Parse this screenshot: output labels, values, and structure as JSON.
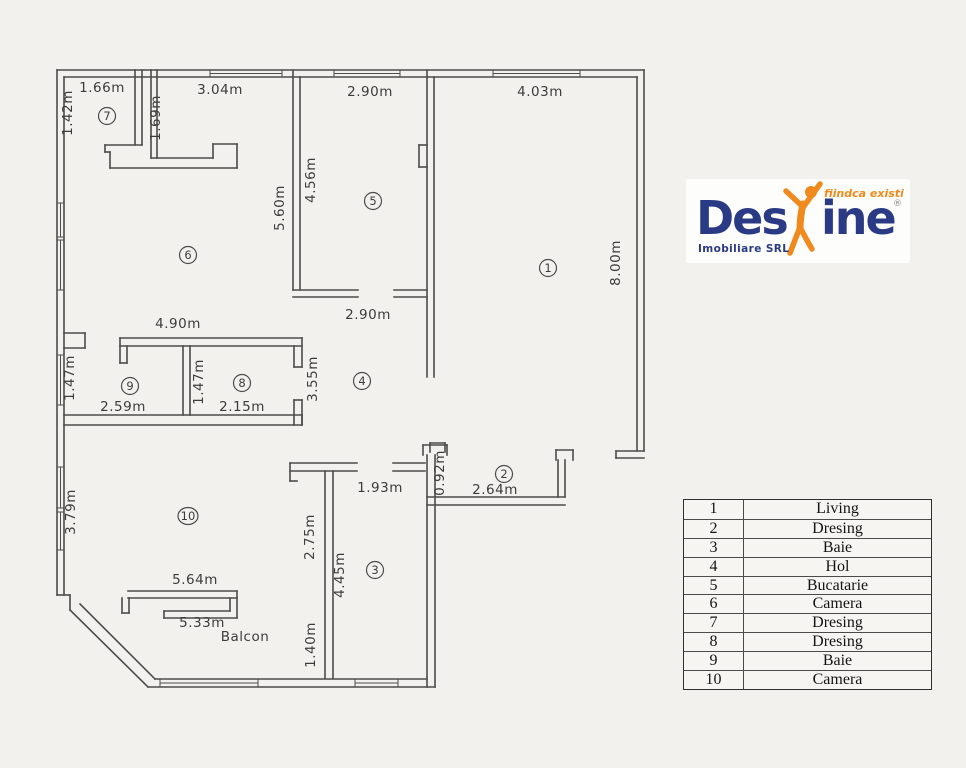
{
  "floorplan": {
    "line_color": "#4c4c4c",
    "text_color": "#3c3c3c",
    "walls": [
      [
        57,
        70,
        644,
        70
      ],
      [
        64,
        77,
        637,
        77
      ],
      [
        644,
        70,
        644,
        451
      ],
      [
        637,
        77,
        637,
        451
      ],
      [
        644,
        451,
        616,
        451
      ],
      [
        616,
        451,
        616,
        458
      ],
      [
        616,
        458,
        644,
        458
      ],
      [
        57,
        70,
        57,
        595
      ],
      [
        64,
        77,
        64,
        595
      ],
      [
        64,
        333,
        85,
        333
      ],
      [
        85,
        333,
        85,
        348
      ],
      [
        64,
        348,
        85,
        348
      ],
      [
        57,
        595,
        70,
        595
      ],
      [
        70,
        595,
        70,
        610
      ],
      [
        70,
        610,
        148,
        687
      ],
      [
        80,
        604,
        155,
        679
      ],
      [
        148,
        687,
        435,
        687
      ],
      [
        155,
        679,
        427,
        679
      ],
      [
        135,
        70,
        135,
        145
      ],
      [
        142,
        70,
        142,
        145
      ],
      [
        105,
        145,
        142,
        145
      ],
      [
        105,
        145,
        105,
        152
      ],
      [
        105,
        152,
        110,
        152
      ],
      [
        110,
        152,
        110,
        168
      ],
      [
        151,
        70,
        151,
        158
      ],
      [
        157,
        70,
        157,
        158
      ],
      [
        151,
        158,
        213,
        158
      ],
      [
        213,
        158,
        213,
        144
      ],
      [
        213,
        144,
        237,
        144
      ],
      [
        237,
        144,
        237,
        168
      ],
      [
        110,
        168,
        237,
        168
      ],
      [
        293,
        70,
        293,
        290
      ],
      [
        300,
        77,
        300,
        290
      ],
      [
        293,
        290,
        358,
        290
      ],
      [
        293,
        297,
        358,
        297
      ],
      [
        394,
        290,
        427,
        290
      ],
      [
        394,
        297,
        427,
        297
      ],
      [
        427,
        70,
        427,
        377
      ],
      [
        434,
        77,
        434,
        377
      ],
      [
        419,
        145,
        427,
        145
      ],
      [
        419,
        145,
        419,
        167
      ],
      [
        419,
        167,
        427,
        167
      ],
      [
        430,
        443,
        445,
        443
      ],
      [
        445,
        443,
        445,
        452
      ],
      [
        430,
        443,
        430,
        452
      ],
      [
        120,
        338,
        302,
        338
      ],
      [
        120,
        346,
        302,
        346
      ],
      [
        120,
        338,
        120,
        363
      ],
      [
        127,
        346,
        127,
        363
      ],
      [
        120,
        363,
        127,
        363
      ],
      [
        294,
        346,
        294,
        367
      ],
      [
        302,
        338,
        302,
        367
      ],
      [
        294,
        367,
        302,
        367
      ],
      [
        294,
        400,
        294,
        425
      ],
      [
        302,
        400,
        302,
        425
      ],
      [
        294,
        400,
        302,
        400
      ],
      [
        183,
        346,
        183,
        415
      ],
      [
        190,
        346,
        190,
        415
      ],
      [
        64,
        415,
        302,
        415
      ],
      [
        64,
        425,
        302,
        425
      ],
      [
        302,
        415,
        302,
        425
      ],
      [
        290,
        463,
        357,
        463
      ],
      [
        290,
        471,
        357,
        471
      ],
      [
        290,
        463,
        290,
        481
      ],
      [
        290,
        481,
        297,
        481
      ],
      [
        325,
        471,
        325,
        678
      ],
      [
        333,
        471,
        333,
        678
      ],
      [
        393,
        463,
        425,
        463
      ],
      [
        393,
        471,
        425,
        471
      ],
      [
        423,
        445,
        447,
        445
      ],
      [
        423,
        445,
        423,
        455
      ],
      [
        447,
        445,
        447,
        455
      ],
      [
        427,
        455,
        427,
        687
      ],
      [
        435,
        455,
        435,
        687
      ],
      [
        427,
        497,
        565,
        497
      ],
      [
        427,
        505,
        565,
        505
      ],
      [
        558,
        460,
        558,
        497
      ],
      [
        565,
        460,
        565,
        497
      ],
      [
        556,
        450,
        573,
        450
      ],
      [
        556,
        450,
        556,
        460
      ],
      [
        573,
        450,
        573,
        460
      ],
      [
        128,
        591,
        237,
        591
      ],
      [
        128,
        598,
        237,
        598
      ],
      [
        122,
        598,
        122,
        613
      ],
      [
        129,
        598,
        129,
        613
      ],
      [
        122,
        613,
        129,
        613
      ],
      [
        237,
        591,
        237,
        618
      ],
      [
        230,
        598,
        230,
        611
      ],
      [
        164,
        611,
        230,
        611
      ],
      [
        164,
        618,
        237,
        618
      ],
      [
        164,
        611,
        164,
        618
      ]
    ],
    "window_lines": [
      [
        210,
        73.5,
        282,
        73.5
      ],
      [
        210,
        70,
        210,
        77
      ],
      [
        282,
        70,
        282,
        77
      ],
      [
        334,
        73.5,
        400,
        73.5
      ],
      [
        334,
        70,
        334,
        77
      ],
      [
        400,
        70,
        400,
        77
      ],
      [
        493,
        73.5,
        580,
        73.5
      ],
      [
        493,
        70,
        493,
        77
      ],
      [
        580,
        70,
        580,
        77
      ],
      [
        60.5,
        203,
        60.5,
        237
      ],
      [
        57,
        203,
        64,
        203
      ],
      [
        57,
        237,
        64,
        237
      ],
      [
        60.5,
        240,
        60.5,
        290
      ],
      [
        57,
        240,
        64,
        240
      ],
      [
        57,
        290,
        64,
        290
      ],
      [
        60.5,
        355,
        60.5,
        405
      ],
      [
        57,
        355,
        64,
        355
      ],
      [
        57,
        405,
        64,
        405
      ],
      [
        60.5,
        467,
        60.5,
        508
      ],
      [
        57,
        467,
        64,
        467
      ],
      [
        57,
        508,
        64,
        508
      ],
      [
        60.5,
        512,
        60.5,
        550
      ],
      [
        57,
        512,
        64,
        512
      ],
      [
        57,
        550,
        64,
        550
      ],
      [
        160,
        683,
        258,
        683
      ],
      [
        160,
        679,
        160,
        687
      ],
      [
        258,
        679,
        258,
        687
      ],
      [
        355,
        683,
        398,
        683
      ],
      [
        355,
        679,
        355,
        687
      ],
      [
        398,
        679,
        398,
        687
      ]
    ],
    "dim_labels_h": [
      {
        "text": "1.66m",
        "x": 102,
        "y": 92
      },
      {
        "text": "3.04m",
        "x": 220,
        "y": 94
      },
      {
        "text": "2.90m",
        "x": 370,
        "y": 96
      },
      {
        "text": "4.03m",
        "x": 540,
        "y": 96
      },
      {
        "text": "4.90m",
        "x": 178,
        "y": 328
      },
      {
        "text": "2.90m",
        "x": 368,
        "y": 319
      },
      {
        "text": "2.59m",
        "x": 123,
        "y": 411
      },
      {
        "text": "2.15m",
        "x": 242,
        "y": 411
      },
      {
        "text": "1.93m",
        "x": 380,
        "y": 492
      },
      {
        "text": "2.64m",
        "x": 495,
        "y": 494
      },
      {
        "text": "5.64m",
        "x": 195,
        "y": 584
      },
      {
        "text": "5.33m",
        "x": 202,
        "y": 627
      },
      {
        "text": "Balcon",
        "x": 245,
        "y": 641
      }
    ],
    "dim_labels_v": [
      {
        "text": "1.42m",
        "x": 72,
        "y": 113
      },
      {
        "text": "1.69m",
        "x": 160,
        "y": 118
      },
      {
        "text": "5.60m",
        "x": 284,
        "y": 208
      },
      {
        "text": "4.56m",
        "x": 315,
        "y": 180
      },
      {
        "text": "8.00m",
        "x": 620,
        "y": 263
      },
      {
        "text": "1.47m",
        "x": 74,
        "y": 378
      },
      {
        "text": "1.47m",
        "x": 203,
        "y": 382
      },
      {
        "text": "3.55m",
        "x": 317,
        "y": 379
      },
      {
        "text": "0.92m",
        "x": 444,
        "y": 473
      },
      {
        "text": "3.79m",
        "x": 75,
        "y": 512
      },
      {
        "text": "2.75m",
        "x": 314,
        "y": 537
      },
      {
        "text": "4.45m",
        "x": 344,
        "y": 575
      },
      {
        "text": "1.40m",
        "x": 315,
        "y": 645
      }
    ],
    "room_markers": [
      {
        "num": "1",
        "x": 548,
        "y": 268
      },
      {
        "num": "2",
        "x": 504,
        "y": 474
      },
      {
        "num": "3",
        "x": 375,
        "y": 570
      },
      {
        "num": "4",
        "x": 362,
        "y": 381
      },
      {
        "num": "5",
        "x": 373,
        "y": 201
      },
      {
        "num": "6",
        "x": 188,
        "y": 255
      },
      {
        "num": "7",
        "x": 107,
        "y": 116
      },
      {
        "num": "8",
        "x": 242,
        "y": 383
      },
      {
        "num": "9",
        "x": 130,
        "y": 386
      },
      {
        "num": "10",
        "x": 188,
        "y": 516
      }
    ]
  },
  "logo": {
    "brand_prefix": "Des",
    "brand_suffix": "ine",
    "registered": "®",
    "tagline": "fiindca existi",
    "subtitle": "Imobiliare SRL",
    "navy": "#2b3a85",
    "orange": "#f08a1d"
  },
  "legend": {
    "rows": [
      {
        "no": "1",
        "name": "Living"
      },
      {
        "no": "2",
        "name": "Dresing"
      },
      {
        "no": "3",
        "name": "Baie"
      },
      {
        "no": "4",
        "name": "Hol"
      },
      {
        "no": "5",
        "name": "Bucatarie"
      },
      {
        "no": "6",
        "name": "Camera"
      },
      {
        "no": "7",
        "name": "Dresing"
      },
      {
        "no": "8",
        "name": "Dresing"
      },
      {
        "no": "9",
        "name": "Baie"
      },
      {
        "no": "10",
        "name": "Camera"
      }
    ]
  }
}
